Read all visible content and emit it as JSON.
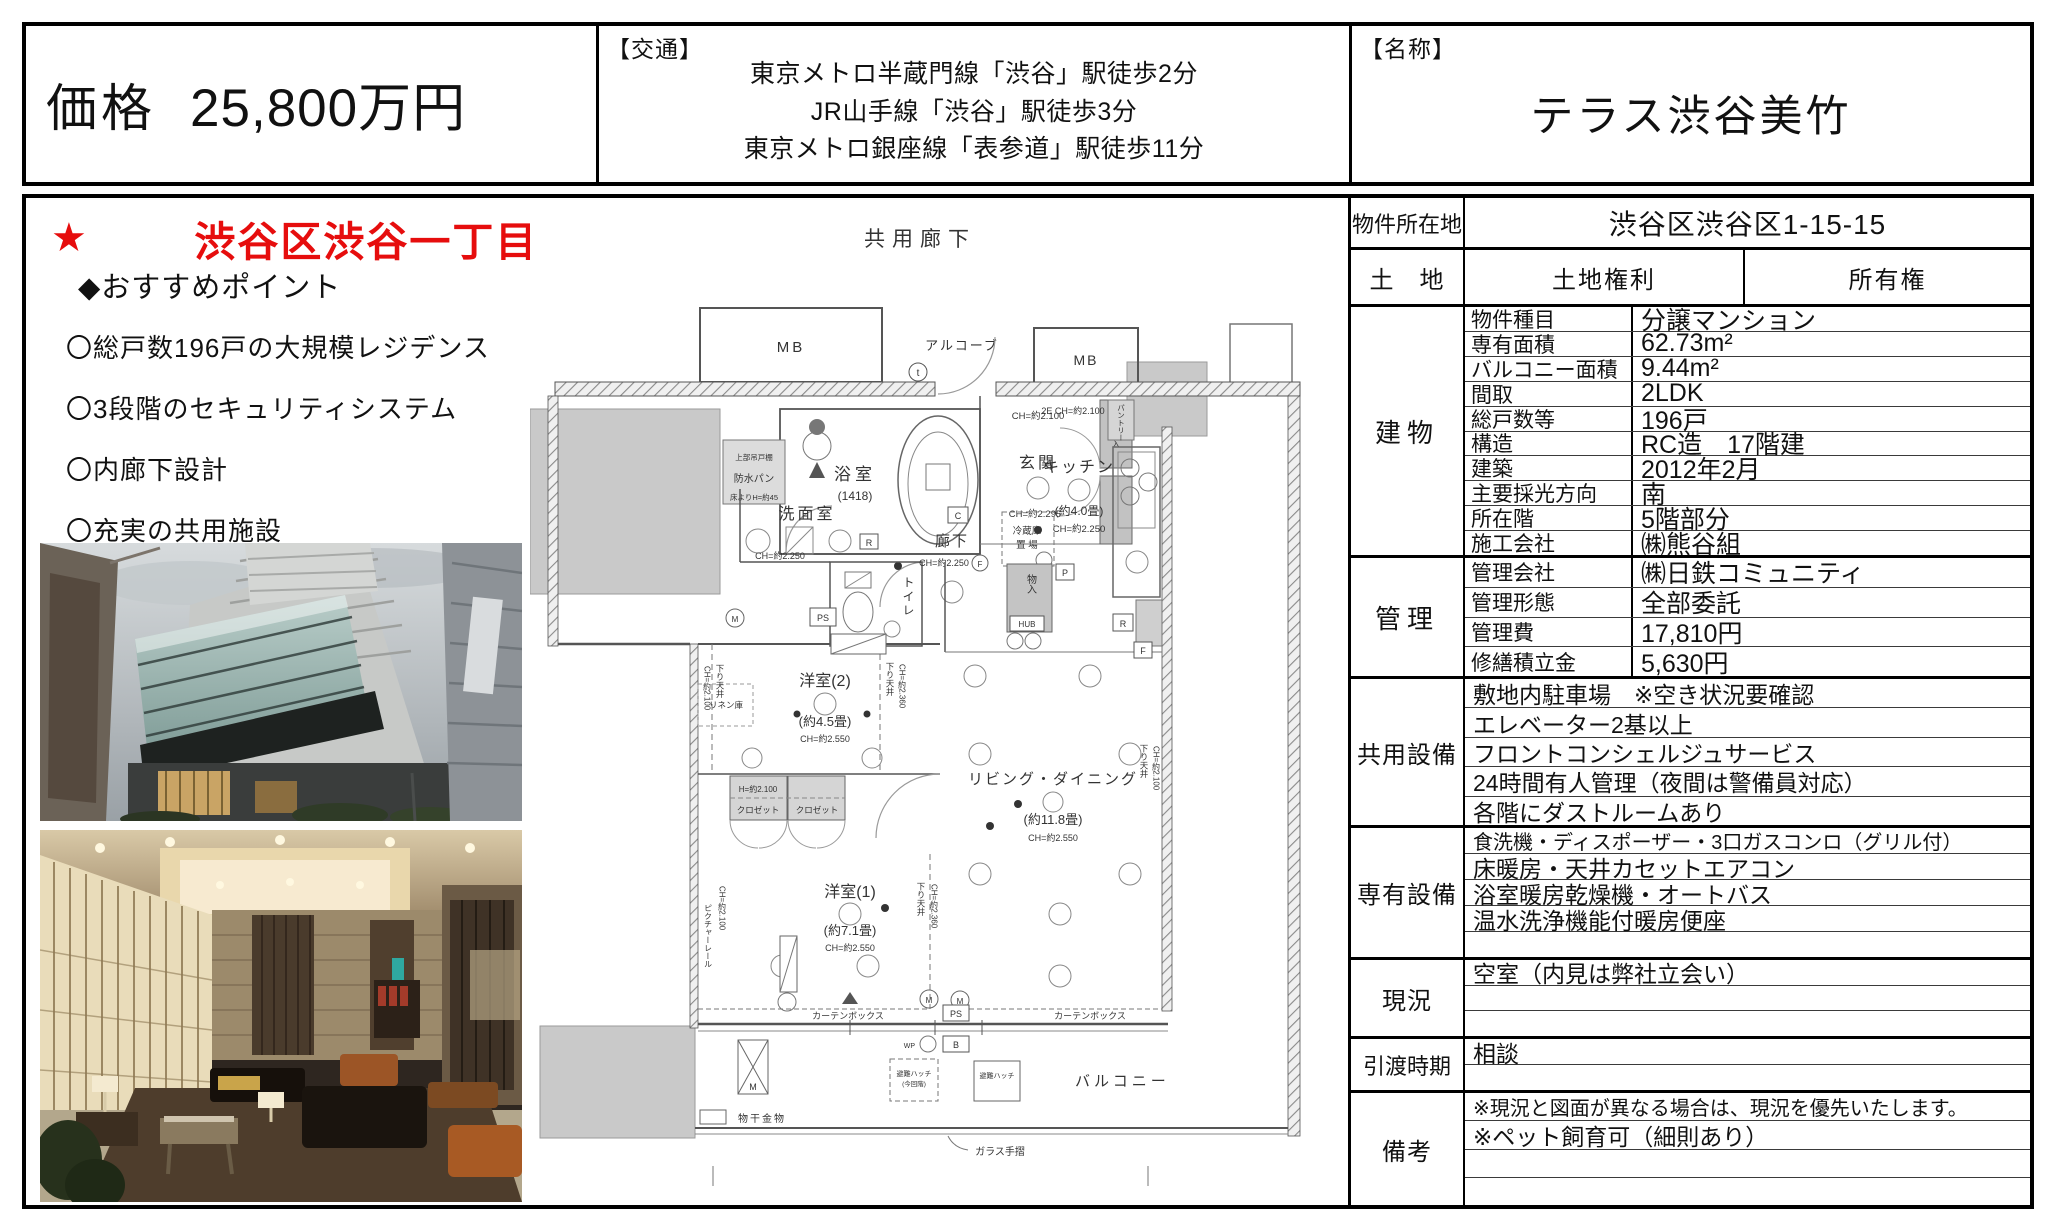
{
  "header": {
    "price_label": "価格",
    "price_value": "25,800万円",
    "transport_tag": "【交通】",
    "transport_lines": [
      "東京メトロ半蔵門線「渋谷」駅徒歩2分",
      "JR山手線「渋谷」駅徒歩3分",
      "東京メトロ銀座線「表参道」駅徒歩11分"
    ],
    "name_tag": "【名称】",
    "name_value": "テラス渋谷美竹"
  },
  "left": {
    "star": "★",
    "headline": "渋谷区渋谷一丁目アドレス・免震タワーレジデンス",
    "points_title": "◆おすすめポイント",
    "points": [
      "〇総戸数196戸の大規模レジデンス",
      "〇3段階のセキュリティシステム",
      "〇内廊下設計",
      "〇充実の共用施設"
    ],
    "accent_color": "#e60d0d"
  },
  "floor_plan": {
    "labels": {
      "corridor": "共用廊下",
      "alcove": "アルコーブ",
      "mb": "MB",
      "bath": "浴室",
      "bath_size": "(1418)",
      "entrance": "玄関",
      "kitchen": "キッチン",
      "kitchen_size": "(約4.0畳)",
      "pantry": "パントリー",
      "fridge1": "冷蔵庫",
      "fridge2": "置 場",
      "washroom": "洗面室",
      "toilet": "トイレ",
      "hall": "廊下",
      "waterproof_pan": "防水パン",
      "upper_cabinet": "上部吊戸棚",
      "floor_h": "床よりH=約45",
      "linen": "リネン庫",
      "lowered_ceiling": "下り天井",
      "picture_rail": "ピクチャーレール",
      "bedroom2": "洋室(2)",
      "bedroom2_size": "(約4.5畳)",
      "closet": "クロゼット",
      "closet_h": "H=約2.100",
      "bedroom1": "洋室(1)",
      "bedroom1_size": "(約7.1畳)",
      "living": "リビング・ダイニング",
      "living_size": "(約11.8畳)",
      "balcony": "バルコニー",
      "curtain_box": "カーテンボックス",
      "drying_fixture": "物干金物",
      "glass_rail": "ガラス手摺",
      "hatch": "避難ハッチ",
      "hatch_note": "(今回階)",
      "storage": "物入",
      "shoe": "下足入",
      "hub": "HUB",
      "ps": "PS",
      "b": "B",
      "m": "M",
      "r": "R",
      "c": "C",
      "f": "F",
      "p": "P",
      "t": "t",
      "wp": "WP",
      "ch2550": "CH=約2.550",
      "ch2250": "CH=約2.250",
      "ch2100": "CH=約2.100",
      "ch2295": "CH=約2.295",
      "ch2360": "CH=約2.360",
      "e2ch": "2E CH=約2.100"
    }
  },
  "table": {
    "location": {
      "label": "物件所在地",
      "value": "渋谷区渋谷区1-15-15"
    },
    "land": {
      "label": "土　地",
      "right_label": "土地権利",
      "value": "所有権"
    },
    "building": {
      "label": "建物",
      "rows": [
        {
          "k": "物件種目",
          "v": "分譲マンション"
        },
        {
          "k": "専有面積",
          "v": "62.73m²"
        },
        {
          "k": "バルコニー面積",
          "v": "9.44m²"
        },
        {
          "k": "間取",
          "v": "2LDK"
        },
        {
          "k": "総戸数等",
          "v": "196戸"
        },
        {
          "k": "構造",
          "v": "RC造　17階建"
        },
        {
          "k": "建築",
          "v": "2012年2月"
        },
        {
          "k": "主要採光方向",
          "v": "南"
        },
        {
          "k": "所在階",
          "v": "5階部分"
        },
        {
          "k": "施工会社",
          "v": "㈱熊谷組"
        }
      ]
    },
    "management": {
      "label": "管理",
      "rows": [
        {
          "k": "管理会社",
          "v": "㈱日鉄コミュニティ"
        },
        {
          "k": "管理形態",
          "v": "全部委託"
        },
        {
          "k": "管理費",
          "v": "17,810円"
        },
        {
          "k": "修繕積立金",
          "v": "5,630円"
        }
      ]
    },
    "shared_facilities": {
      "label": "共用設備",
      "rows": [
        "敷地内駐車場　※空き状況要確認",
        "エレベーター2基以上",
        "フロントコンシェルジュサービス",
        "24時間有人管理（夜間は警備員対応）",
        "各階にダストルームあり"
      ]
    },
    "private_facilities": {
      "label": "専有設備",
      "rows": [
        "食洗機・ディスポーザー・3口ガスコンロ（グリル付）",
        "床暖房・天井カセットエアコン",
        "浴室暖房乾燥機・オートバス",
        "温水洗浄機能付暖房便座",
        ""
      ]
    },
    "current_status": {
      "label": "現況",
      "rows": [
        "空室（内見は弊社立会い）",
        "",
        ""
      ]
    },
    "handover": {
      "label": "引渡時期",
      "rows": [
        "相談",
        ""
      ]
    },
    "remarks": {
      "label": "備考",
      "rows": [
        "※現況と図面が異なる場合は、現況を優先いたします。",
        "※ペット飼育可（細則あり）",
        "",
        ""
      ]
    }
  }
}
